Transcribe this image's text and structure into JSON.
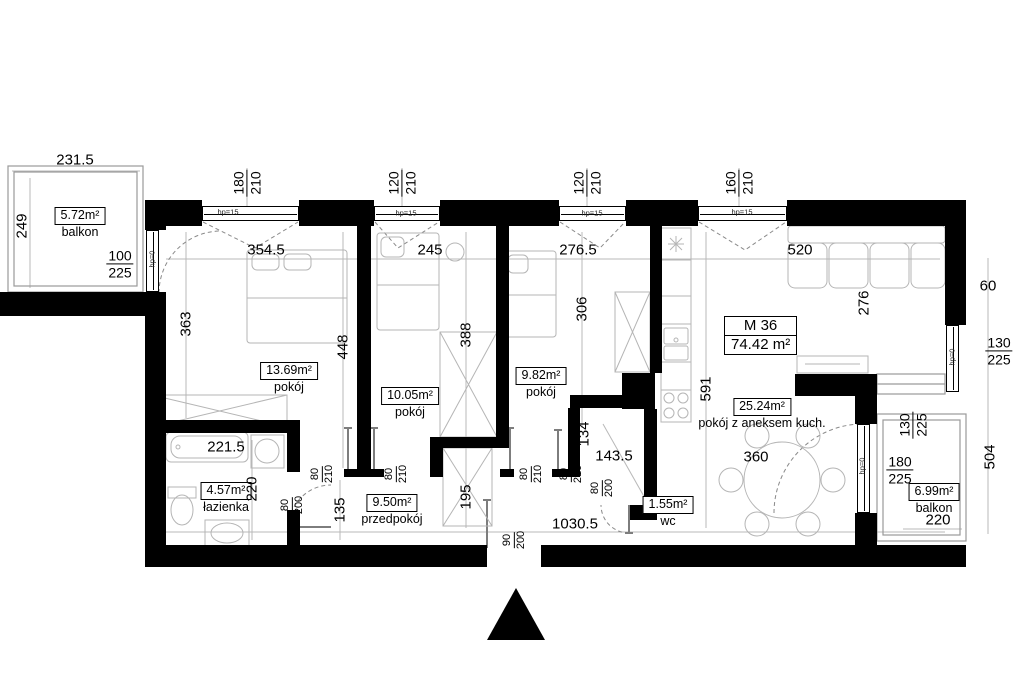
{
  "unit": {
    "id": "M 36",
    "area": "74.42 m²"
  },
  "rooms": {
    "balkonTL": {
      "area": "5.72m²",
      "name": "balkon"
    },
    "p1": {
      "area": "13.69m²",
      "name": "pokój"
    },
    "p2": {
      "area": "10.05m²",
      "name": "pokój"
    },
    "p3": {
      "area": "9.82m²",
      "name": "pokój"
    },
    "bath": {
      "area": "4.57m²",
      "name": "łazienka"
    },
    "hall": {
      "area": "9.50m²",
      "name": "przedpokój"
    },
    "wc": {
      "area": "1.55m²",
      "name": "wc"
    },
    "living": {
      "area": "25.24m²",
      "name": "pokój z aneksem kuch."
    },
    "balkonBR": {
      "area": "6.99m²",
      "name": "balkon"
    }
  },
  "dims": {
    "balkonTLw": "231.5",
    "balkonTLh": "249",
    "balkonTLdoorW": "100",
    "balkonTLdoorH": "225",
    "win1w": "180",
    "win2w": "120",
    "win3w": "120",
    "win4w": "160",
    "winH": "210",
    "r1w": "354.5",
    "r2w": "245",
    "r3w": "276.5",
    "livingW": "520",
    "offR": "60",
    "livingH": "276",
    "winRw": "130",
    "winRh": "225",
    "rightH": "504",
    "r1h": "363",
    "mid12": "448",
    "r2h": "388",
    "r3h": "306",
    "kitchenH": "591",
    "bathW": "221.5",
    "bathH": "220",
    "hall1": "135",
    "hall2": "195",
    "wcW": "143.5",
    "wcH": "134",
    "tableD": "360",
    "totalW": "1030.5",
    "brDoorW": "180",
    "brDoorH": "225",
    "brWinW": "130",
    "brWinH": "225",
    "balkonBRw": "220",
    "d80": "80",
    "d210": "210",
    "d200": "200",
    "d90": "90",
    "hp15": "hp=15",
    "hp0": "hp=0"
  }
}
